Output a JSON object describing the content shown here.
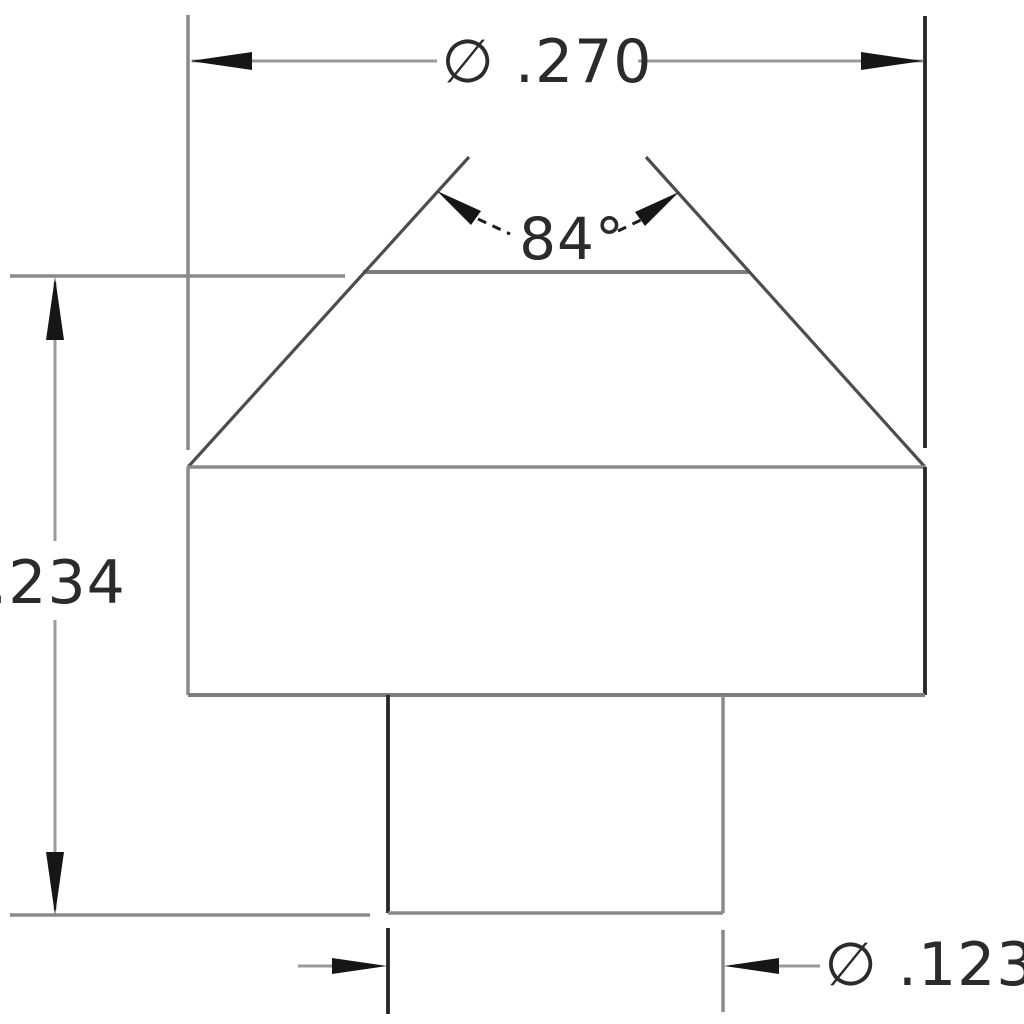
{
  "sheet": {
    "background": "#ffffff",
    "view": "front-section-profile"
  },
  "dimensions": {
    "top_diameter": {
      "label": "∅ .270",
      "value": 0.27,
      "kind": "diameter"
    },
    "cone_angle": {
      "label": "84°",
      "value": 84,
      "kind": "angle"
    },
    "overall_height": {
      "label": ".234",
      "value": 0.234,
      "kind": "linear-vertical"
    },
    "shaft_diameter": {
      "label": "∅ .123",
      "value": 0.123,
      "kind": "diameter"
    }
  },
  "colors": {
    "line_gray": "#8a8a8a",
    "line_mid": "#4d4d4d",
    "line_dark": "#262626",
    "edge_gray": "#7d7d7d",
    "arrow_black": "#161616",
    "text": "#2b2b2b"
  }
}
